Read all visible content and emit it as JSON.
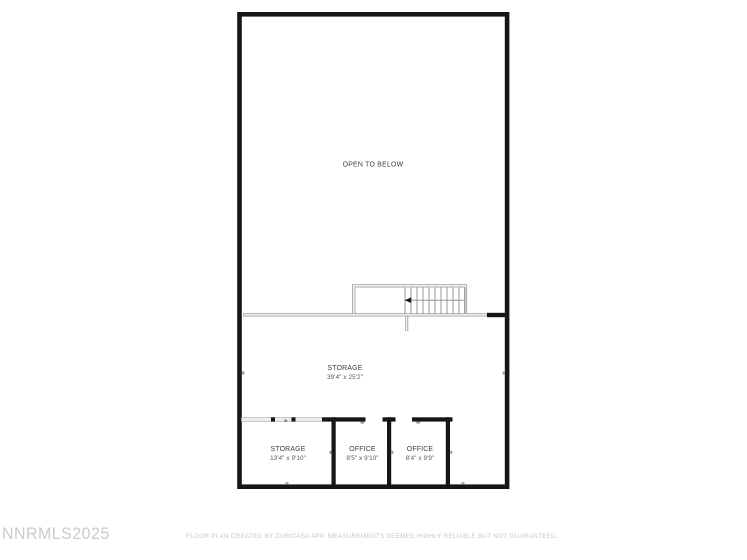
{
  "plan": {
    "open_area_label": "OPEN TO BELOW",
    "rooms": [
      {
        "name": "STORAGE",
        "dimensions": "39'4\" x 25'2\""
      },
      {
        "name": "STORAGE",
        "dimensions": "13'4\" x 9'10\""
      },
      {
        "name": "OFFICE",
        "dimensions": "8'5\" x 9'10\""
      },
      {
        "name": "OFFICE",
        "dimensions": "8'4\" x 9'9\""
      }
    ]
  },
  "footer": {
    "watermark": "NNRMLS2025",
    "disclaimer": "FLOOR PLAN CREATED BY CUBICASA APP. MEASUREMENTS DEEMED HIGHLY RELIABLE BUT NOT GUARANTEED."
  },
  "colors": {
    "wall": "#161616",
    "rail": "#8a8a8a",
    "tread": "#999999",
    "glass-fill": "#ececec",
    "glass-edge": "#b3b3b3",
    "label": "#3d3d3d",
    "dims": "#555555",
    "watermark": "#cbcbcb",
    "disclaimer": "#c6c6c6",
    "bg": "#ffffff"
  }
}
